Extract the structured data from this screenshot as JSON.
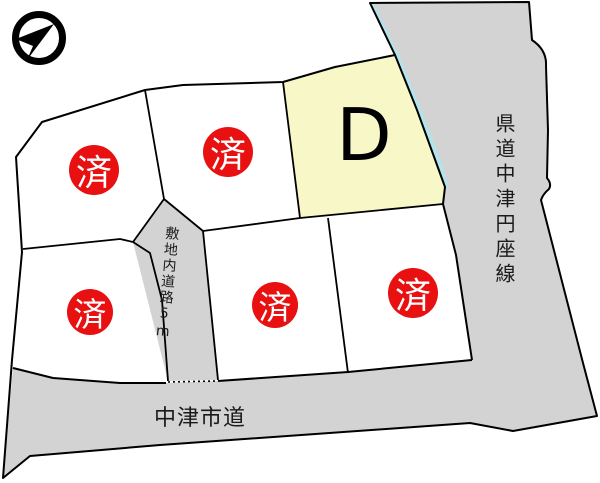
{
  "diagram_type": "land-subdivision-map",
  "compass": {
    "icon": "north-arrow"
  },
  "plots": [
    {
      "name": "upper-left",
      "status_badge": "済"
    },
    {
      "name": "upper-middle",
      "status_badge": "済"
    },
    {
      "name": "plot-d",
      "label": "D"
    },
    {
      "name": "lower-left",
      "status_badge": "済"
    },
    {
      "name": "lower-middle",
      "status_badge": "済"
    },
    {
      "name": "lower-right",
      "status_badge": "済"
    }
  ],
  "roads": {
    "prefectural_label": "県道中津円座線",
    "city_label": "中津市道",
    "internal_label": "敷地内道路5m"
  },
  "colors": {
    "road_gray": "#d3d3d3",
    "available_plot_yellow": "#f7f7c8",
    "sold_badge_red": "#e81010",
    "edge_highlight_cyan": "#aee5ef",
    "outline_black": "#000000",
    "background_white": "#ffffff"
  }
}
